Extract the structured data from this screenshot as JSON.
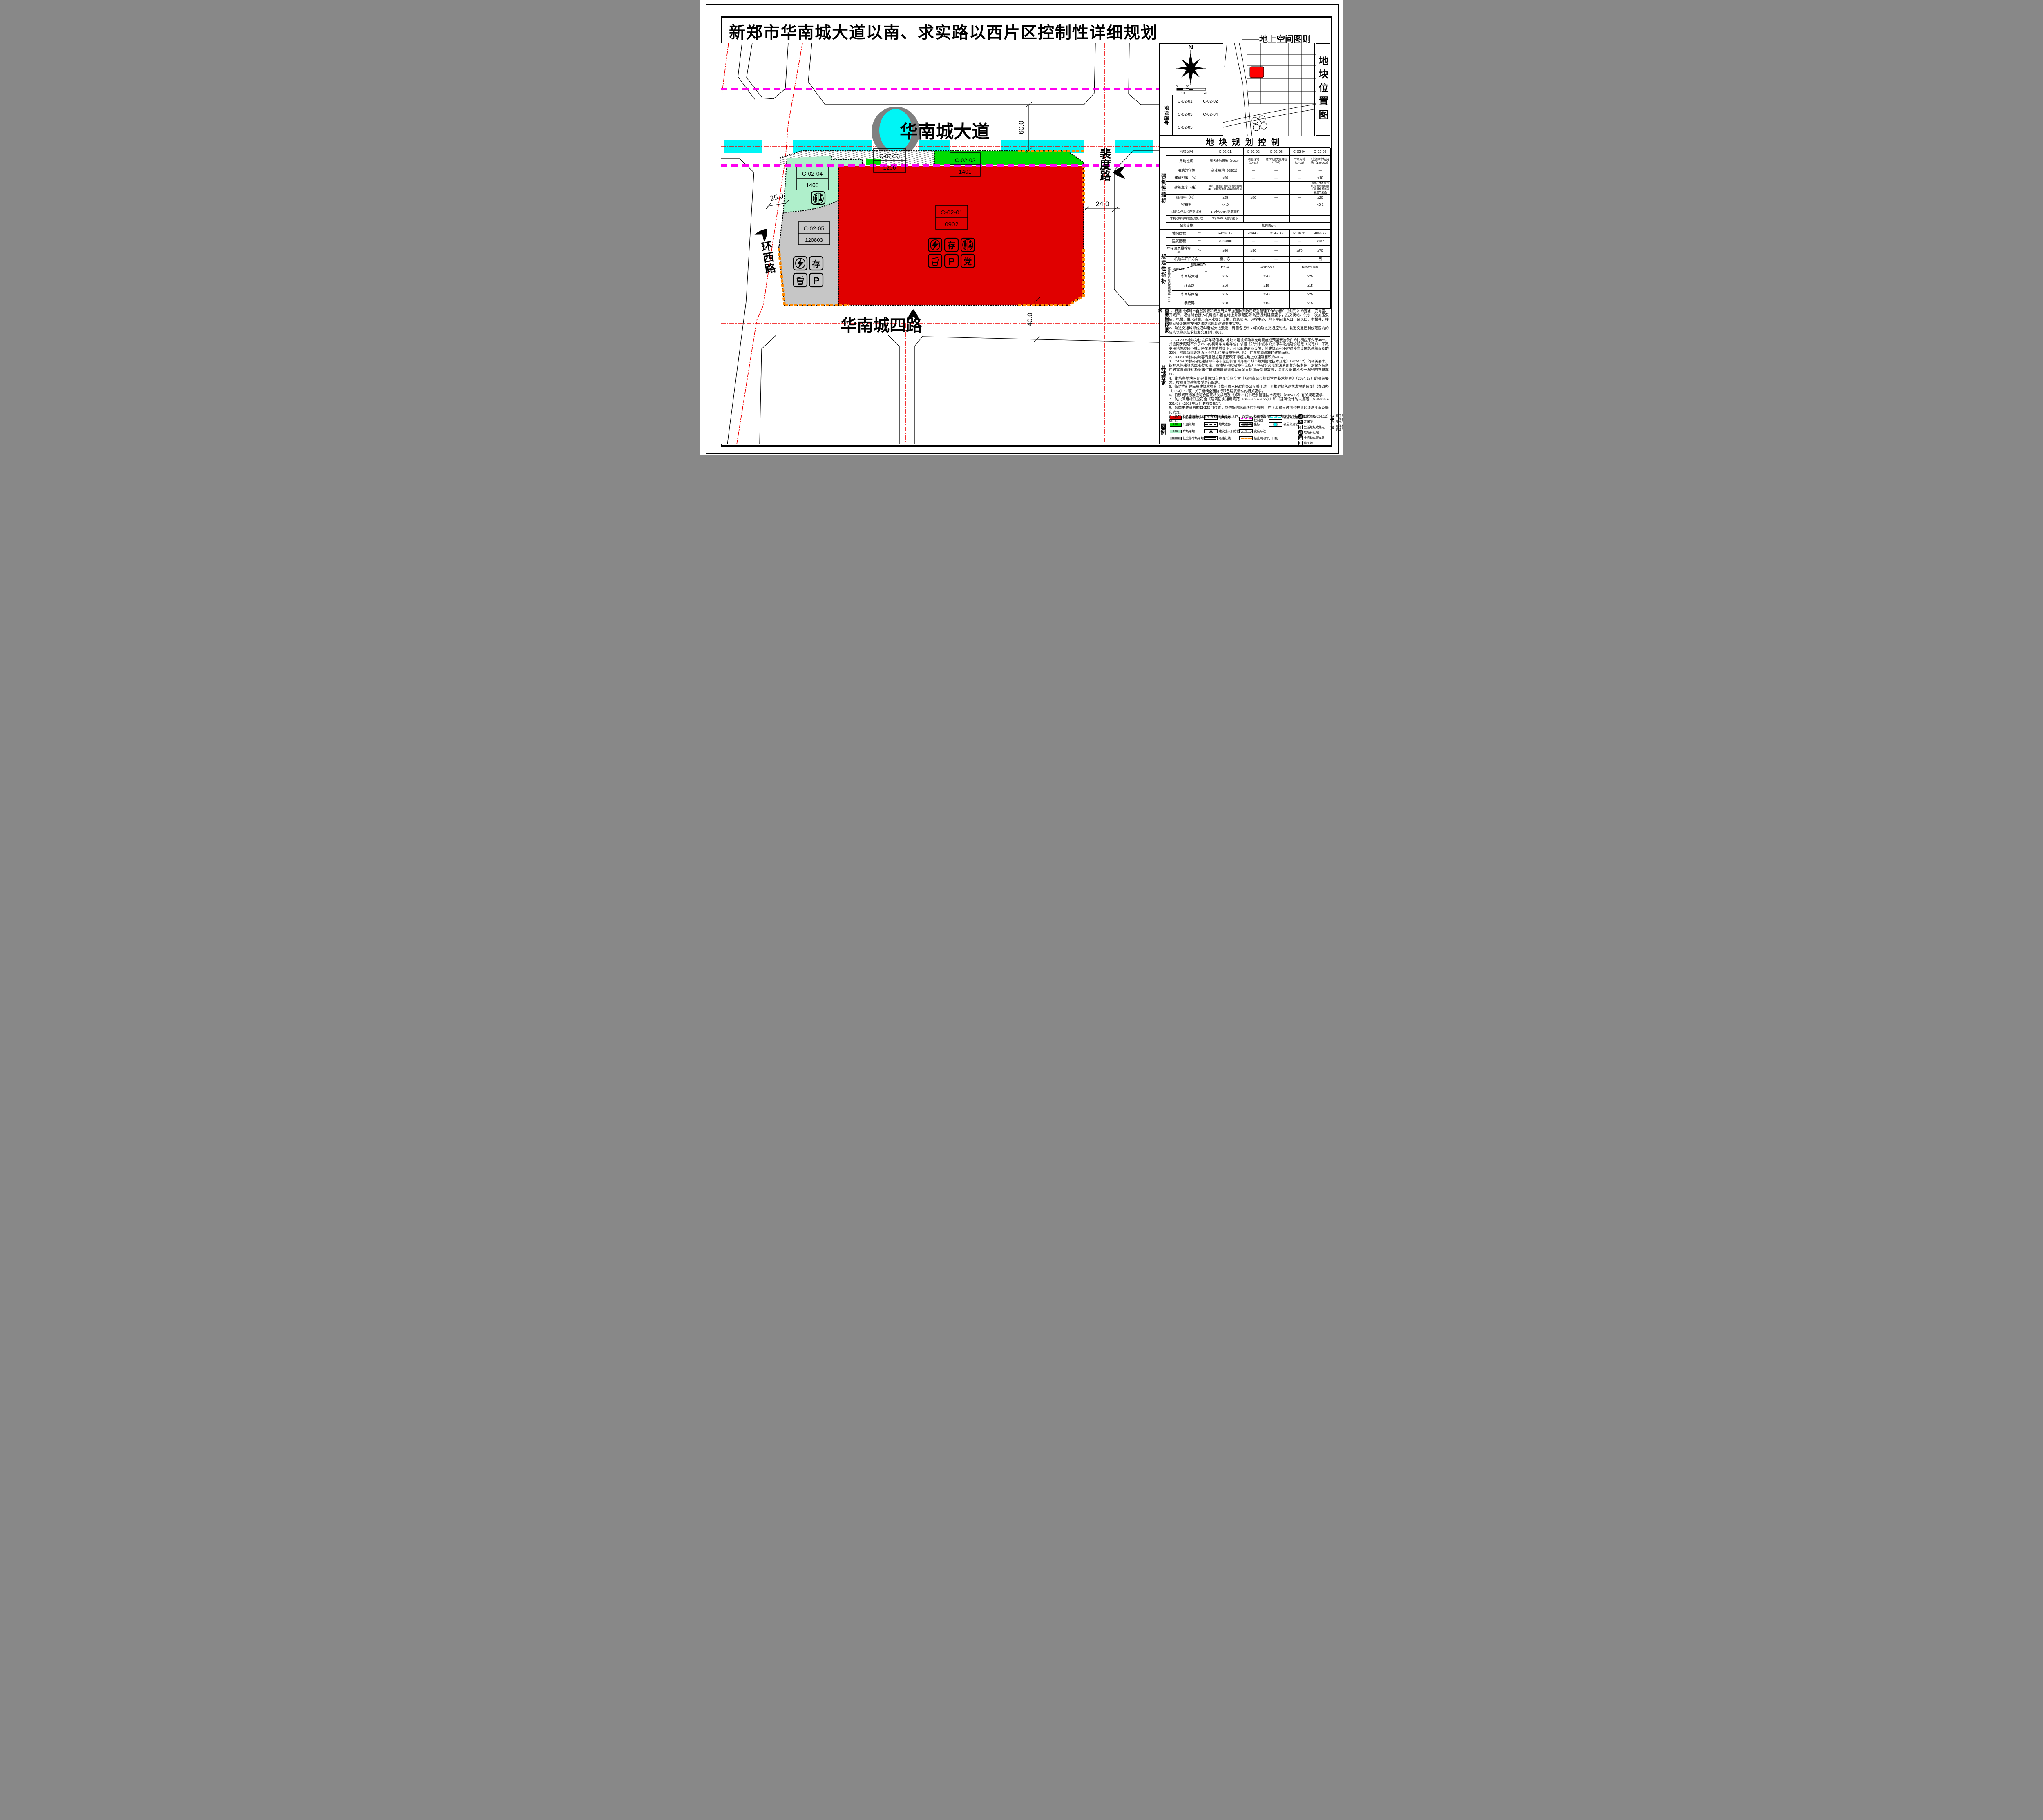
{
  "page": {
    "title": "新郑市华南城大道以南、求实路以西片区控制性详细规划",
    "subtitle": "——地上空间图则"
  },
  "colors": {
    "commerce_red": "#E00000",
    "park_green": "#00DC00",
    "plaza_lightgreen": "#AFEFCB",
    "parking_gray": "#C6C6C6",
    "rail_cyan": "#00F5F5",
    "rail_control_magenta": "#FF00F0",
    "no_opening_orange": "#FF8A00",
    "road_centerline_red": "#F00000"
  },
  "map": {
    "roads": {
      "ave": "华南城大道",
      "ring": "环西路",
      "s4": "华南城四路",
      "peidu": "裴度路"
    },
    "dims": {
      "ave": "60.0",
      "ring": "25.0",
      "s4": "40.0",
      "peidu": "24.0"
    },
    "plots": [
      {
        "id": "C-02-01",
        "code": "0902"
      },
      {
        "id": "C-02-02",
        "code": "1401"
      },
      {
        "id": "C-02-03",
        "code": "1206"
      },
      {
        "id": "C-02-04",
        "code": "1403"
      },
      {
        "id": "C-02-05",
        "code": "120803"
      }
    ],
    "glyphs": {
      "cun": "存",
      "P": "P",
      "dang": "党"
    }
  },
  "panel1": {
    "caption": "地块位置图",
    "north": "N",
    "scale_ticks": {
      "t0": "0",
      "t20": "20",
      "t10": "10",
      "t40": "40"
    },
    "table_label": "地块编号",
    "rows": [
      [
        "C-02-01",
        "C-02-02"
      ],
      [
        "C-02-03",
        "C-02-04"
      ],
      [
        "C-02-05",
        ""
      ],
      [
        "",
        ""
      ]
    ]
  },
  "control": {
    "title": "地块规划控制",
    "side_top": "强制性指标",
    "side_bottom": "规定性指标",
    "setback_label": "建筑后退道路红线距离（m）",
    "diag_top": "建筑高度(m)",
    "diag_bottom": "道路名称",
    "header": {
      "label": "地块编号",
      "c1": "C-02-01",
      "c2": "C-02-02",
      "c3": "C-02-03",
      "c4": "C-02-04",
      "c5": "C-02-05"
    },
    "rows": [
      {
        "label": "用地性质",
        "values": [
          "商务金融用地（0902）",
          "公园绿地（1401）",
          "城市轨道交通用地（1206）",
          "广场用地（1403）",
          "社会停车场用地（120803）"
        ]
      },
      {
        "label": "用地兼容性",
        "values": [
          "商业用地（0901）",
          "—",
          "—",
          "—",
          "—"
        ]
      },
      {
        "label": "建筑密度（%）",
        "values": [
          "<50",
          "—",
          "—",
          "—",
          "<10"
        ]
      },
      {
        "label": "建筑高度（米）",
        "values": [
          "<80，且须符合机场管理机构关于项目核准净空高度的复函",
          "—",
          "—",
          "—",
          "<10，且须符合机场管理机构关于项目核准净空高度的复函"
        ]
      },
      {
        "label": "绿地率（%）",
        "values": [
          "≥25",
          "≥80",
          "—",
          "—",
          "≥20"
        ]
      },
      {
        "label": "容积率",
        "values": [
          "<4.0",
          "—",
          "—",
          "—",
          "<0.1"
        ]
      },
      {
        "label": "机动车停车位配建标准",
        "values": [
          "1.5个/100m²建筑面积",
          "—",
          "—",
          "—",
          "—"
        ]
      },
      {
        "label": "非机动车停车位配建标准",
        "values": [
          "2个/100m²建筑面积",
          "—",
          "—",
          "—",
          "—"
        ]
      },
      {
        "label": "配套设施",
        "values": [
          "如图所示"
        ]
      },
      {
        "label": "地块面积",
        "unit": "m²",
        "values": [
          "59202.17",
          "4299.7",
          "2195.06",
          "5179.31",
          "9866.72"
        ]
      },
      {
        "label": "建筑面积",
        "unit": "m²",
        "values": [
          "<236800",
          "—",
          "—",
          "—",
          "<987"
        ]
      },
      {
        "label": "年径流总量控制率",
        "unit": "%",
        "values": [
          "≥80",
          "≥90",
          "—",
          "≥70",
          "≥70"
        ]
      },
      {
        "label": "机动车开口方向",
        "values": [
          "南、东",
          "—",
          "—",
          "—",
          "西"
        ]
      },
      {
        "label": "height_bands",
        "values": [
          "H≤24",
          "24<H≤60",
          "60<H≤100"
        ]
      },
      {
        "label": "华南城大道",
        "values": [
          "≥15",
          "≥20",
          "≥25"
        ]
      },
      {
        "label": "环西路",
        "values": [
          "≥10",
          "≥15",
          "≥15"
        ]
      },
      {
        "label": "华南城四路",
        "values": [
          "≥15",
          "≥20",
          "≥25"
        ]
      },
      {
        "label": "裴度路",
        "values": [
          "≥10",
          "≥15",
          "≥15"
        ]
      }
    ]
  },
  "requirements": {
    "label": "重要管控要求",
    "text": "1、根据《郑州市自然资源和规划局关于加强防洪防涝规划管理工作的通知（试行）》的要求，变电室、开闭所、通信综合接入机房应布置在地上并满足防洪防涝规划建设要求，热交换站、供水二次加压泵房、电梯、供水设施、雨污水提升设施、应急照明、消控中心、地下空间出入口、通风口、电梯井、楼梯间等设施应按照防洪防涝规划建设要求实施。\n2、轨道交通城郊线沿华南城大道敷设，两侧各控制50米的轨道交通控制线，轨道交通控制线范围内的建构筑物须征求轨道交通部门意见。"
  },
  "other": {
    "label": "其他要求",
    "text": "1、C-02-05地块为社会停车场用地，地块内建设机动车充电设施或预留安装条件的比例应不少于40%，并应同步配建不少于25%的机动车充电车位；依据《郑州市城市公共停车设施建设规定（试行）》，不改变用地性质且不减少停车泊位的前提下，可以配建商业设施，其建筑面积不超过停车设施总建筑面积的20%，附属商业设施面积不包括停车设施管理用房、停车辅助设施的建筑面积。\n2、C-02-01地块内兼容商业设施建筑面积不得超过地上总建筑面积的40%。\n3、C-02-01地块内配建机动车停车位应符合《郑州市城市规划管理技术规定》（2024.12）的相关要求，按照具体建筑类型进行配建，该地块内配建停车位应100%建设充电设施或预留安装条件，预留安装条件时需将管线和桥架等供电设施建设到位以满足直接装表接电需要，应同步配建不少于30%的充电车位。\n4、街坊各地块内配建非机动车停车位应符合《郑州市城市规划管理技术规定》（2024.12）的相关要求，按照具体建筑类型进行配建。\n5、街坊内新建民用建筑应符合《郑州市人民政府办公厅关于进一步推进绿色建筑发展的通知》（郑政办〔2024〕17号）关于继续全面执行绿色建筑标准的相关要求。\n6、日照间距标准应符合国家相关规范及《郑州市城市规划管理技术规定》（2024.12）有关规定要求。\n7、防火间距标准应符合《建筑防火通用规范（GB55037-2022）》和《建筑设计防火规范（GB50016-2014）》（2018年版）的有关规定。\n8、各类市政管线的具体接口位置，应依据道路管线综合规划，在下步建设时结合规划地块总平面及竖向确定。\n9、其他未尽事宜按照河南省郑州市相关规范、政策要求及《郑州市城市规划管理技术规定》（2024.12）执行。"
  },
  "legend": {
    "label": "图例",
    "land_use": [
      {
        "code": "0902",
        "label": "商务金融用地"
      },
      {
        "code": "1401",
        "label": "公园绿地"
      },
      {
        "code": "1403",
        "label": "广场用地"
      },
      {
        "code": "120803",
        "label": "社会停车场用地"
      }
    ],
    "plot_symbols": [
      {
        "sample": "C-02-01",
        "label": "地块编号"
      },
      {
        "label": "地块边界"
      },
      {
        "label": "建议出入口方位"
      },
      {
        "label": "道路红线"
      }
    ],
    "line_symbols": [
      {
        "label": "轨道交通控制线"
      },
      {
        "label": "坐标",
        "x": "X=44329.000",
        "y": "Y=62730.913"
      },
      {
        "label": "宽度标注",
        "value": "40"
      },
      {
        "label": "禁止机动车开口段"
      }
    ],
    "rail_symbols": [
      {
        "label": "轨道交通线"
      },
      {
        "label": "轨道交通站"
      }
    ],
    "facilities": [
      {
        "label": "公共厕所"
      },
      {
        "label": "开闭所"
      },
      {
        "label": "生活垃圾收集点"
      },
      {
        "glyph": "垃",
        "label": "垃圾转运站"
      },
      {
        "glyph": "存",
        "label": "非机动车存车处"
      },
      {
        "glyph": "P",
        "label": "停车场"
      }
    ],
    "facilities2": [
      {
        "glyph": "党",
        "label": "楼宇党组织工作用房"
      },
      {
        "label": "变电室"
      },
      {
        "glyph": "邮",
        "label": "邮件快递送达设施"
      }
    ]
  }
}
